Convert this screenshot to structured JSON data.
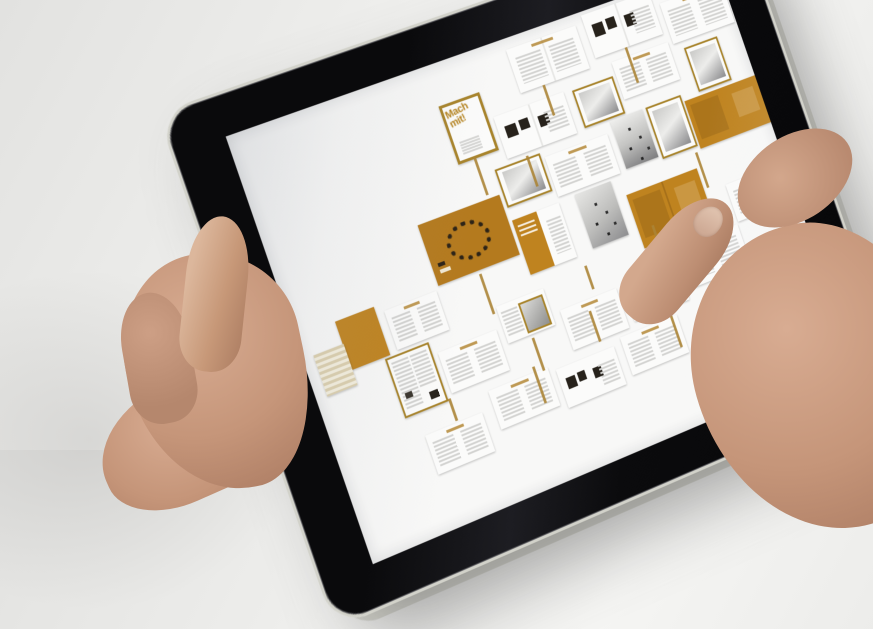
{
  "scene": {
    "description": "Photograph of two hands holding a black tablet in landscape; the screen shows a magazine flatplan overview of page spreads with orange accents; a right thumb touches the screen near an orange page.",
    "background_color": "#efefed",
    "skin_tone": "#c59579"
  },
  "device": {
    "type": "tablet",
    "bezel_color": "#0c0c0e",
    "rim_color": "#d2d2ca",
    "home_button": {
      "present": true,
      "icon": "rounded-square"
    },
    "screen_background": "#f8f8f7"
  },
  "screen": {
    "app": "magazine-flatplan-viewer",
    "cover_title": "Mach mit!",
    "accent_orange": "#bf831f",
    "frame_orange": "#a8842c",
    "connector_color": "#ab8436",
    "spreads": [
      {
        "kind": "text",
        "x": 318,
        "y": 12,
        "w": 84,
        "h": 48
      },
      {
        "kind": "thumbs",
        "x": 412,
        "y": 4,
        "w": 84,
        "h": 48
      },
      {
        "kind": "text",
        "x": 504,
        "y": 20,
        "w": 78,
        "h": 46
      },
      {
        "kind": "cover",
        "x": 226,
        "y": 44,
        "w": 42,
        "h": 58,
        "label": "Mach mit!"
      },
      {
        "kind": "thumbs",
        "x": 280,
        "y": 74,
        "w": 84,
        "h": 46
      },
      {
        "kind": "photo-sm",
        "x": 374,
        "y": 76,
        "w": 46,
        "h": 38
      },
      {
        "kind": "text",
        "x": 428,
        "y": 62,
        "w": 70,
        "h": 42
      },
      {
        "kind": "photo-tall",
        "x": 514,
        "y": 74,
        "w": 38,
        "h": 46
      },
      {
        "kind": "photo-ls",
        "x": 262,
        "y": 126,
        "w": 50,
        "h": 38
      },
      {
        "kind": "text",
        "x": 320,
        "y": 132,
        "w": 76,
        "h": 44
      },
      {
        "kind": "gradient-tall",
        "x": 404,
        "y": 120,
        "w": 40,
        "h": 54
      },
      {
        "kind": "photo-tall",
        "x": 448,
        "y": 120,
        "w": 40,
        "h": 54
      },
      {
        "kind": "orange",
        "x": 494,
        "y": 128,
        "w": 90,
        "h": 54
      },
      {
        "kind": "orange-people",
        "x": 162,
        "y": 152,
        "w": 96,
        "h": 66
      },
      {
        "kind": "orange-heading",
        "x": 262,
        "y": 182,
        "w": 56,
        "h": 60
      },
      {
        "kind": "gradient-dots",
        "x": 338,
        "y": 180,
        "w": 44,
        "h": 60
      },
      {
        "kind": "orange-pages",
        "x": 394,
        "y": 200,
        "w": 88,
        "h": 60
      },
      {
        "kind": "solid-orange",
        "x": 45,
        "y": 214,
        "w": 44,
        "h": 52
      },
      {
        "kind": "striped",
        "x": 12,
        "y": 238,
        "w": 34,
        "h": 44
      },
      {
        "kind": "text",
        "x": 98,
        "y": 222,
        "w": 60,
        "h": 42
      },
      {
        "kind": "newsprint",
        "x": 82,
        "y": 268,
        "w": 46,
        "h": 60
      },
      {
        "kind": "text",
        "x": 138,
        "y": 282,
        "w": 68,
        "h": 44
      },
      {
        "kind": "car",
        "x": 214,
        "y": 260,
        "w": 56,
        "h": 40
      },
      {
        "kind": "text",
        "x": 280,
        "y": 288,
        "w": 68,
        "h": 44
      },
      {
        "kind": "thumbs",
        "x": 356,
        "y": 284,
        "w": 68,
        "h": 44
      },
      {
        "kind": "text-orange",
        "x": 430,
        "y": 272,
        "w": 76,
        "h": 46
      },
      {
        "kind": "text",
        "x": 508,
        "y": 228,
        "w": 76,
        "h": 42
      },
      {
        "kind": "text",
        "x": 176,
        "y": 338,
        "w": 70,
        "h": 42
      },
      {
        "kind": "thumbs",
        "x": 254,
        "y": 344,
        "w": 70,
        "h": 42
      },
      {
        "kind": "text",
        "x": 334,
        "y": 338,
        "w": 70,
        "h": 42
      },
      {
        "kind": "text",
        "x": 96,
        "y": 356,
        "w": 66,
        "h": 42
      }
    ],
    "connectors": [
      [
        344,
        60,
        34
      ],
      [
        448,
        52,
        40
      ],
      [
        244,
        106,
        42
      ],
      [
        300,
        124,
        34
      ],
      [
        486,
        184,
        40
      ],
      [
        208,
        222,
        44
      ],
      [
        240,
        304,
        36
      ],
      [
        322,
        254,
        26
      ],
      [
        410,
        240,
        28
      ],
      [
        132,
        330,
        24
      ],
      [
        230,
        332,
        40
      ],
      [
        310,
        300,
        34
      ],
      [
        396,
        332,
        40
      ]
    ]
  }
}
